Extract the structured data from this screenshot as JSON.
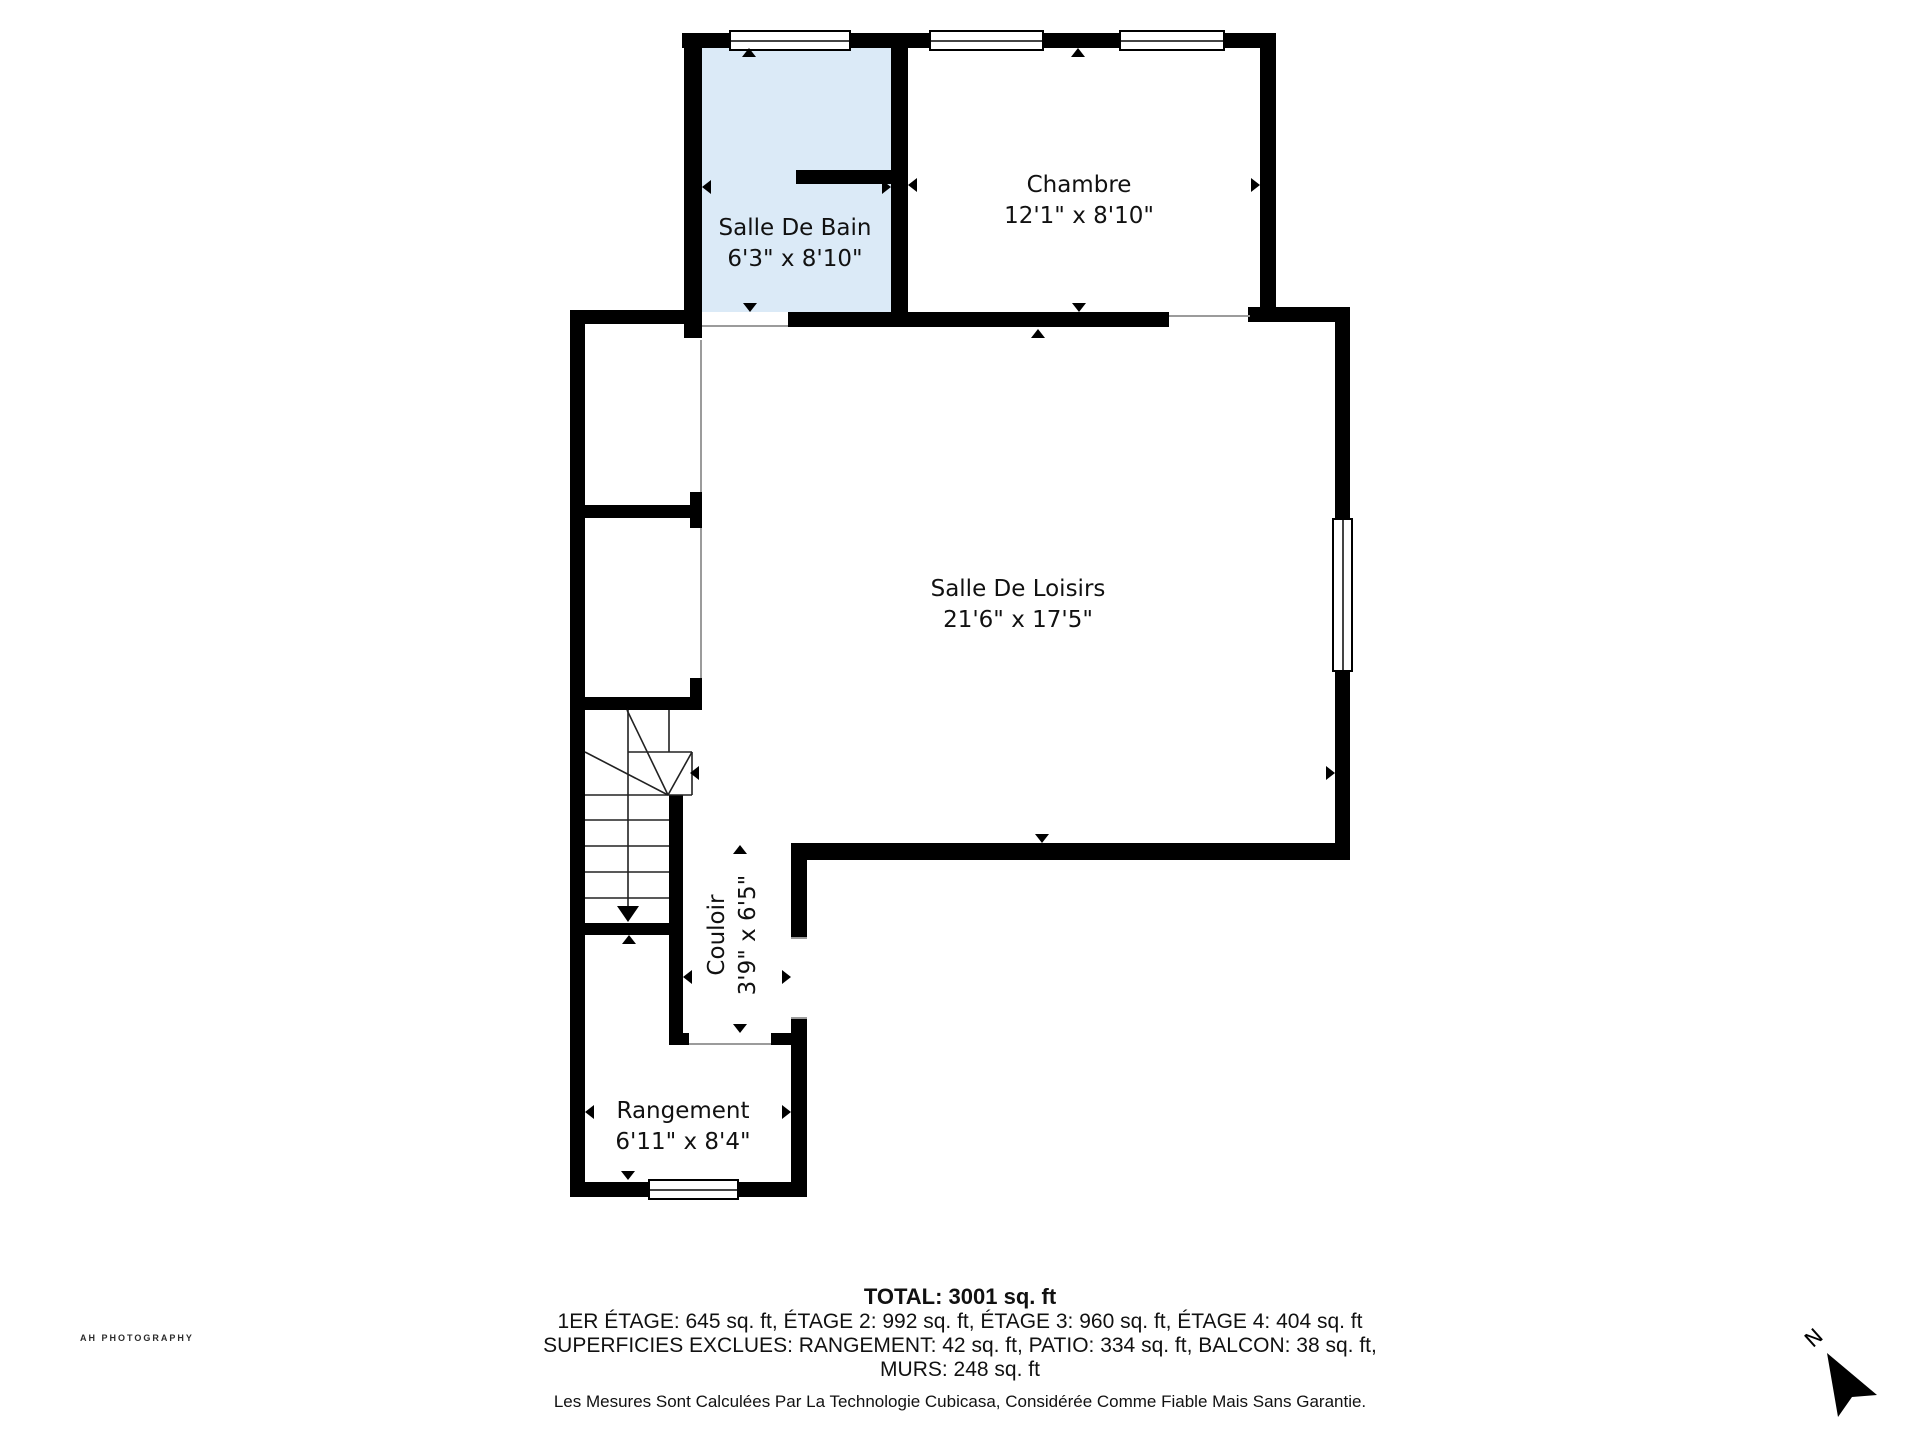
{
  "plan": {
    "rooms": [
      {
        "name": "Salle De Bain",
        "dims": "6'3\" x 8'10\""
      },
      {
        "name": "Chambre",
        "dims": "12'1\" x 8'10\""
      },
      {
        "name": "Salle De Loisirs",
        "dims": "21'6\" x 17'5\""
      },
      {
        "name": "Couloir",
        "dims": "3'9\" x 6'5\""
      },
      {
        "name": "Rangement",
        "dims": "6'11\" x 8'4\""
      }
    ],
    "colors": {
      "wall": "#000000",
      "bathroom_fill": "#dbeaf7",
      "thin_line": "#9b9b9b"
    }
  },
  "footer": {
    "total": "TOTAL: 3001 sq. ft",
    "floors": "1ER ÉTAGE: 645 sq. ft, ÉTAGE 2: 992 sq. ft, ÉTAGE 3: 960 sq. ft, ÉTAGE 4: 404 sq. ft",
    "exclusions_line1": "SUPERFICIES EXCLUES: RANGEMENT: 42 sq. ft, PATIO: 334 sq. ft, BALCON: 38 sq. ft,",
    "exclusions_line2": "MURS: 248 sq. ft",
    "disclaimer": "Les Mesures Sont Calculées Par La Technologie Cubicasa, Considérée Comme Fiable Mais Sans Garantie."
  },
  "watermark": "AH PHOTOGRAPHY",
  "compass": {
    "label": "N"
  }
}
